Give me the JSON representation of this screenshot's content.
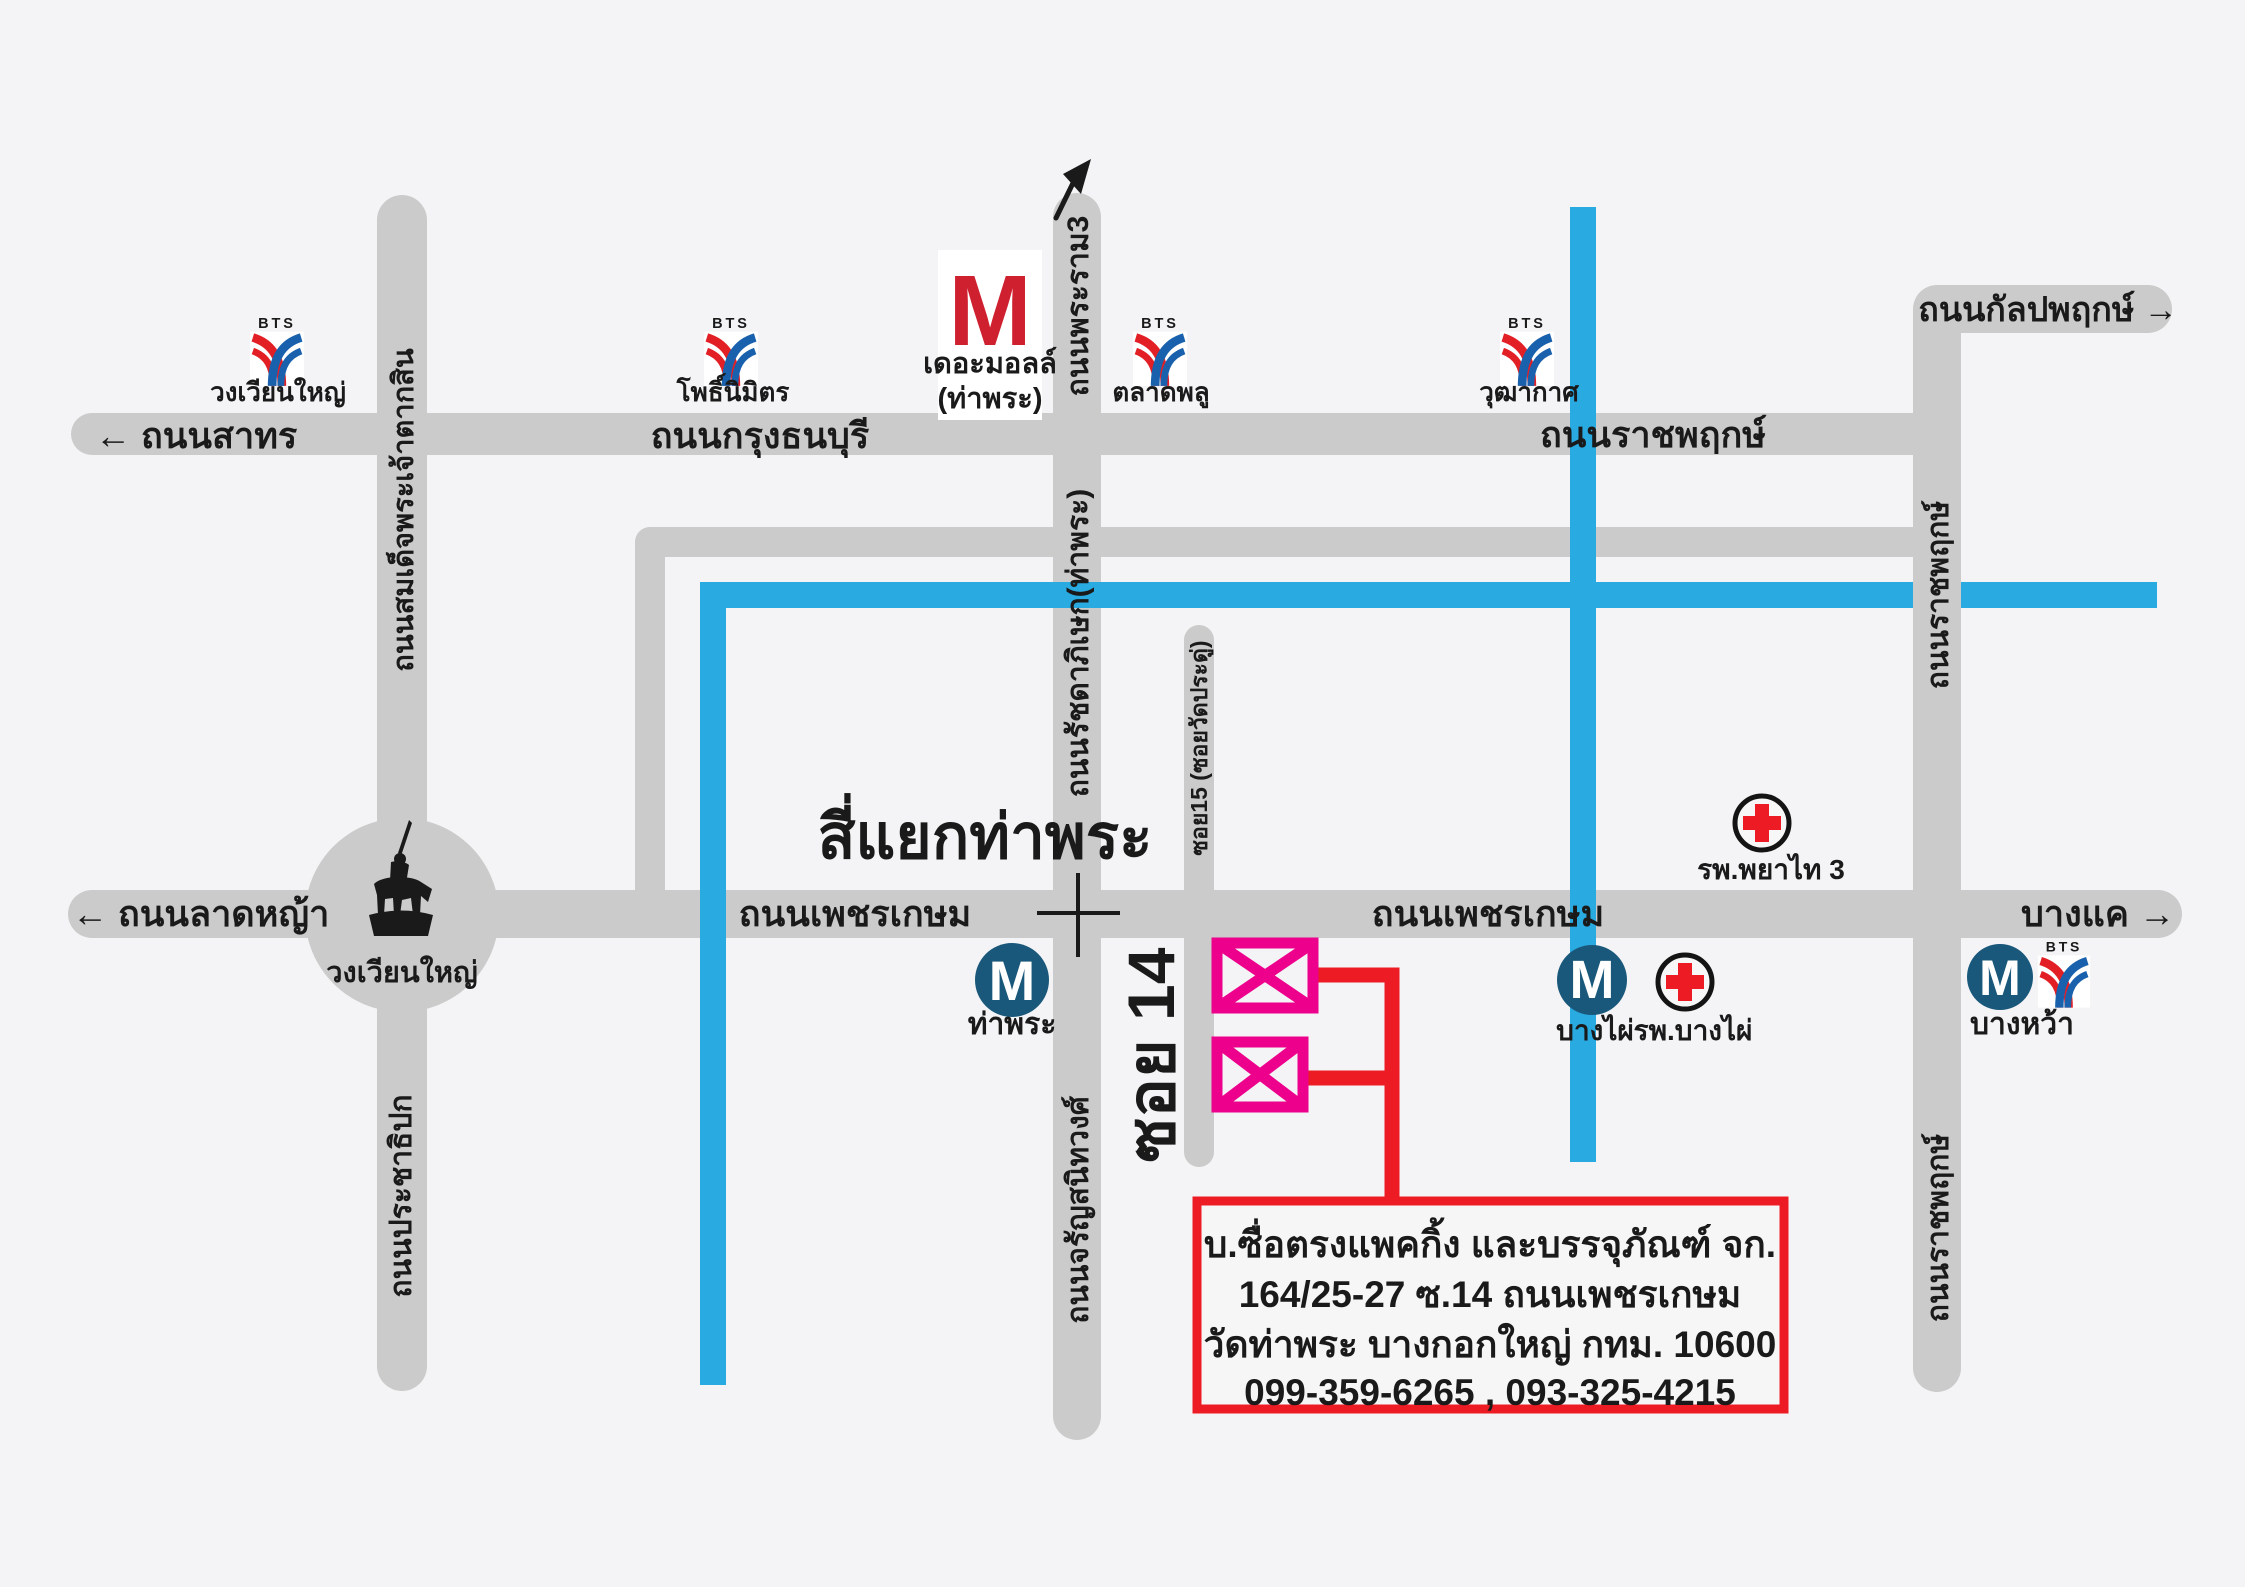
{
  "colors": {
    "background": "#f4f4f6",
    "road": "#cbcbcb",
    "canal_blue": "#29abe2",
    "route_red": "#ed1c24",
    "building_magenta": "#ec008c",
    "mrt_navy": "#19587a",
    "bts_red": "#e31f26",
    "bts_blue": "#1961ac",
    "mall_red": "#cf2030",
    "hospital_red": "#ed1c24",
    "text": "#1a1a1a"
  },
  "roads": {
    "sathorn": "← ถนนสาทร",
    "krung_thonburi": "ถนนกรุงธนบุรี",
    "ratchaphruek": "ถนนราชพฤกษ์",
    "kanlapaphruek": "ถนนกัลปพฤกษ์ →",
    "lat_ya": "← ถนนลาดหญ้า",
    "phetkasem": "ถนนเพชรเกษม",
    "bang_khae": "บางแค →",
    "somdet_phrachao_taksin": "ถนนสมเด็จพระเจ้าตากสิน",
    "prachathipok": "ถนนประชาธิปก",
    "rama3": "ถนนพระราม3",
    "ratchadaphisek_tha_phra": "ถนนรัชดาภิเษก(ท่าพระ)",
    "charansanitwong": "ถนนจรัญสนิทวงศ์",
    "soi15": "ซอย15 (ซอยวัดประดู่)",
    "soi14": "ซอย 14"
  },
  "landmarks": {
    "tha_phra_intersection": "สี่แยกท่าพระ",
    "wongwian_yai": "วงเวียนใหญ่"
  },
  "transit": {
    "bts_brand": "BTS",
    "mrt_letter": "M",
    "stations": {
      "wongwian_yai": "วงเวียนใหญ่",
      "pho_nimit": "โพธิ์นิมิตร",
      "talat_phlu": "ตลาดพลู",
      "wutthakat": "วุฒากาศ",
      "tha_phra": "ท่าพระ",
      "bang_phai": "บางไผ่",
      "bang_wa": "บางหว้า"
    }
  },
  "places": {
    "the_mall": {
      "letter": "M",
      "name": "เดอะมอลล์",
      "branch": "(ท่าพระ)"
    },
    "phyathai3_hospital": "รพ.พยาไท 3",
    "bang_phai_hospital": "รพ.บางไผ่"
  },
  "address_box": {
    "line1": "บ.ซื่อตรงแพคกิ้ง และบรรจุภัณฑ์ จก.",
    "line2": "164/25-27 ซ.14 ถนนเพชรเกษม",
    "line3": "วัดท่าพระ บางกอกใหญ่ กทม. 10600",
    "line4": "099-359-6265 , 093-325-4215"
  }
}
